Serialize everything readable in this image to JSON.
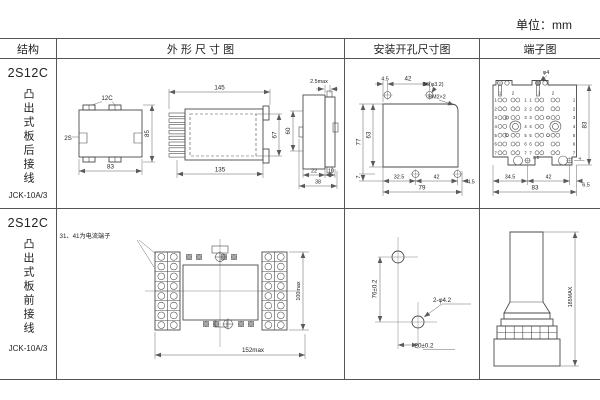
{
  "unit_label": "单位：mm",
  "palette": {
    "ink": "#4a4a4a",
    "border": "#555555",
    "background": "#ffffff"
  },
  "headers": {
    "structure": "结构",
    "outline": "外 形 尺 寸 图",
    "install": "安装开孔尺寸图",
    "terminal": "端子图"
  },
  "rows": [
    {
      "model": "2S12C",
      "mount": "凸出式板后接线",
      "code": "JCK-10A/3"
    },
    {
      "model": "2S12C",
      "mount": "凸出式板前接线",
      "code": "JCK-10A/3"
    }
  ],
  "r1": {
    "front": {
      "w_top": "12C",
      "side": "2S",
      "w_bottom": "83",
      "h_right": "85"
    },
    "side": {
      "l_top": "145",
      "l_bottom": "135",
      "h1": "67",
      "h2": "60",
      "panel": "2.5max",
      "d1": "22",
      "d2": "10",
      "d3": "38"
    },
    "install": {
      "t1": "4.5",
      "t2": "42",
      "hole": "B6(φ3.2)",
      "corner": "RM2×2",
      "v1": "77",
      "v2": "63",
      "v3": "7",
      "b1": "32.5",
      "b2": "42",
      "b3": "4.5",
      "b4": "79"
    },
    "terminal": {
      "screw": "φ4",
      "height": "83",
      "gap": "8.6",
      "edge": "4",
      "b1": "34.5",
      "b2": "42",
      "b3": "6.5",
      "b4": "83",
      "col_labels": [
        "1",
        "2",
        "1",
        "2"
      ],
      "row_labels": [
        "1",
        "2",
        "3",
        "4",
        "5",
        "6",
        "7"
      ]
    }
  },
  "r2": {
    "front": {
      "note": "31、41为电流端子",
      "width": "152max",
      "height": "100max"
    },
    "install": {
      "v": "76±0.2",
      "h": "20±0.2",
      "holes": "2-φ4.2"
    },
    "terminal": {
      "height": "185MAX"
    }
  }
}
